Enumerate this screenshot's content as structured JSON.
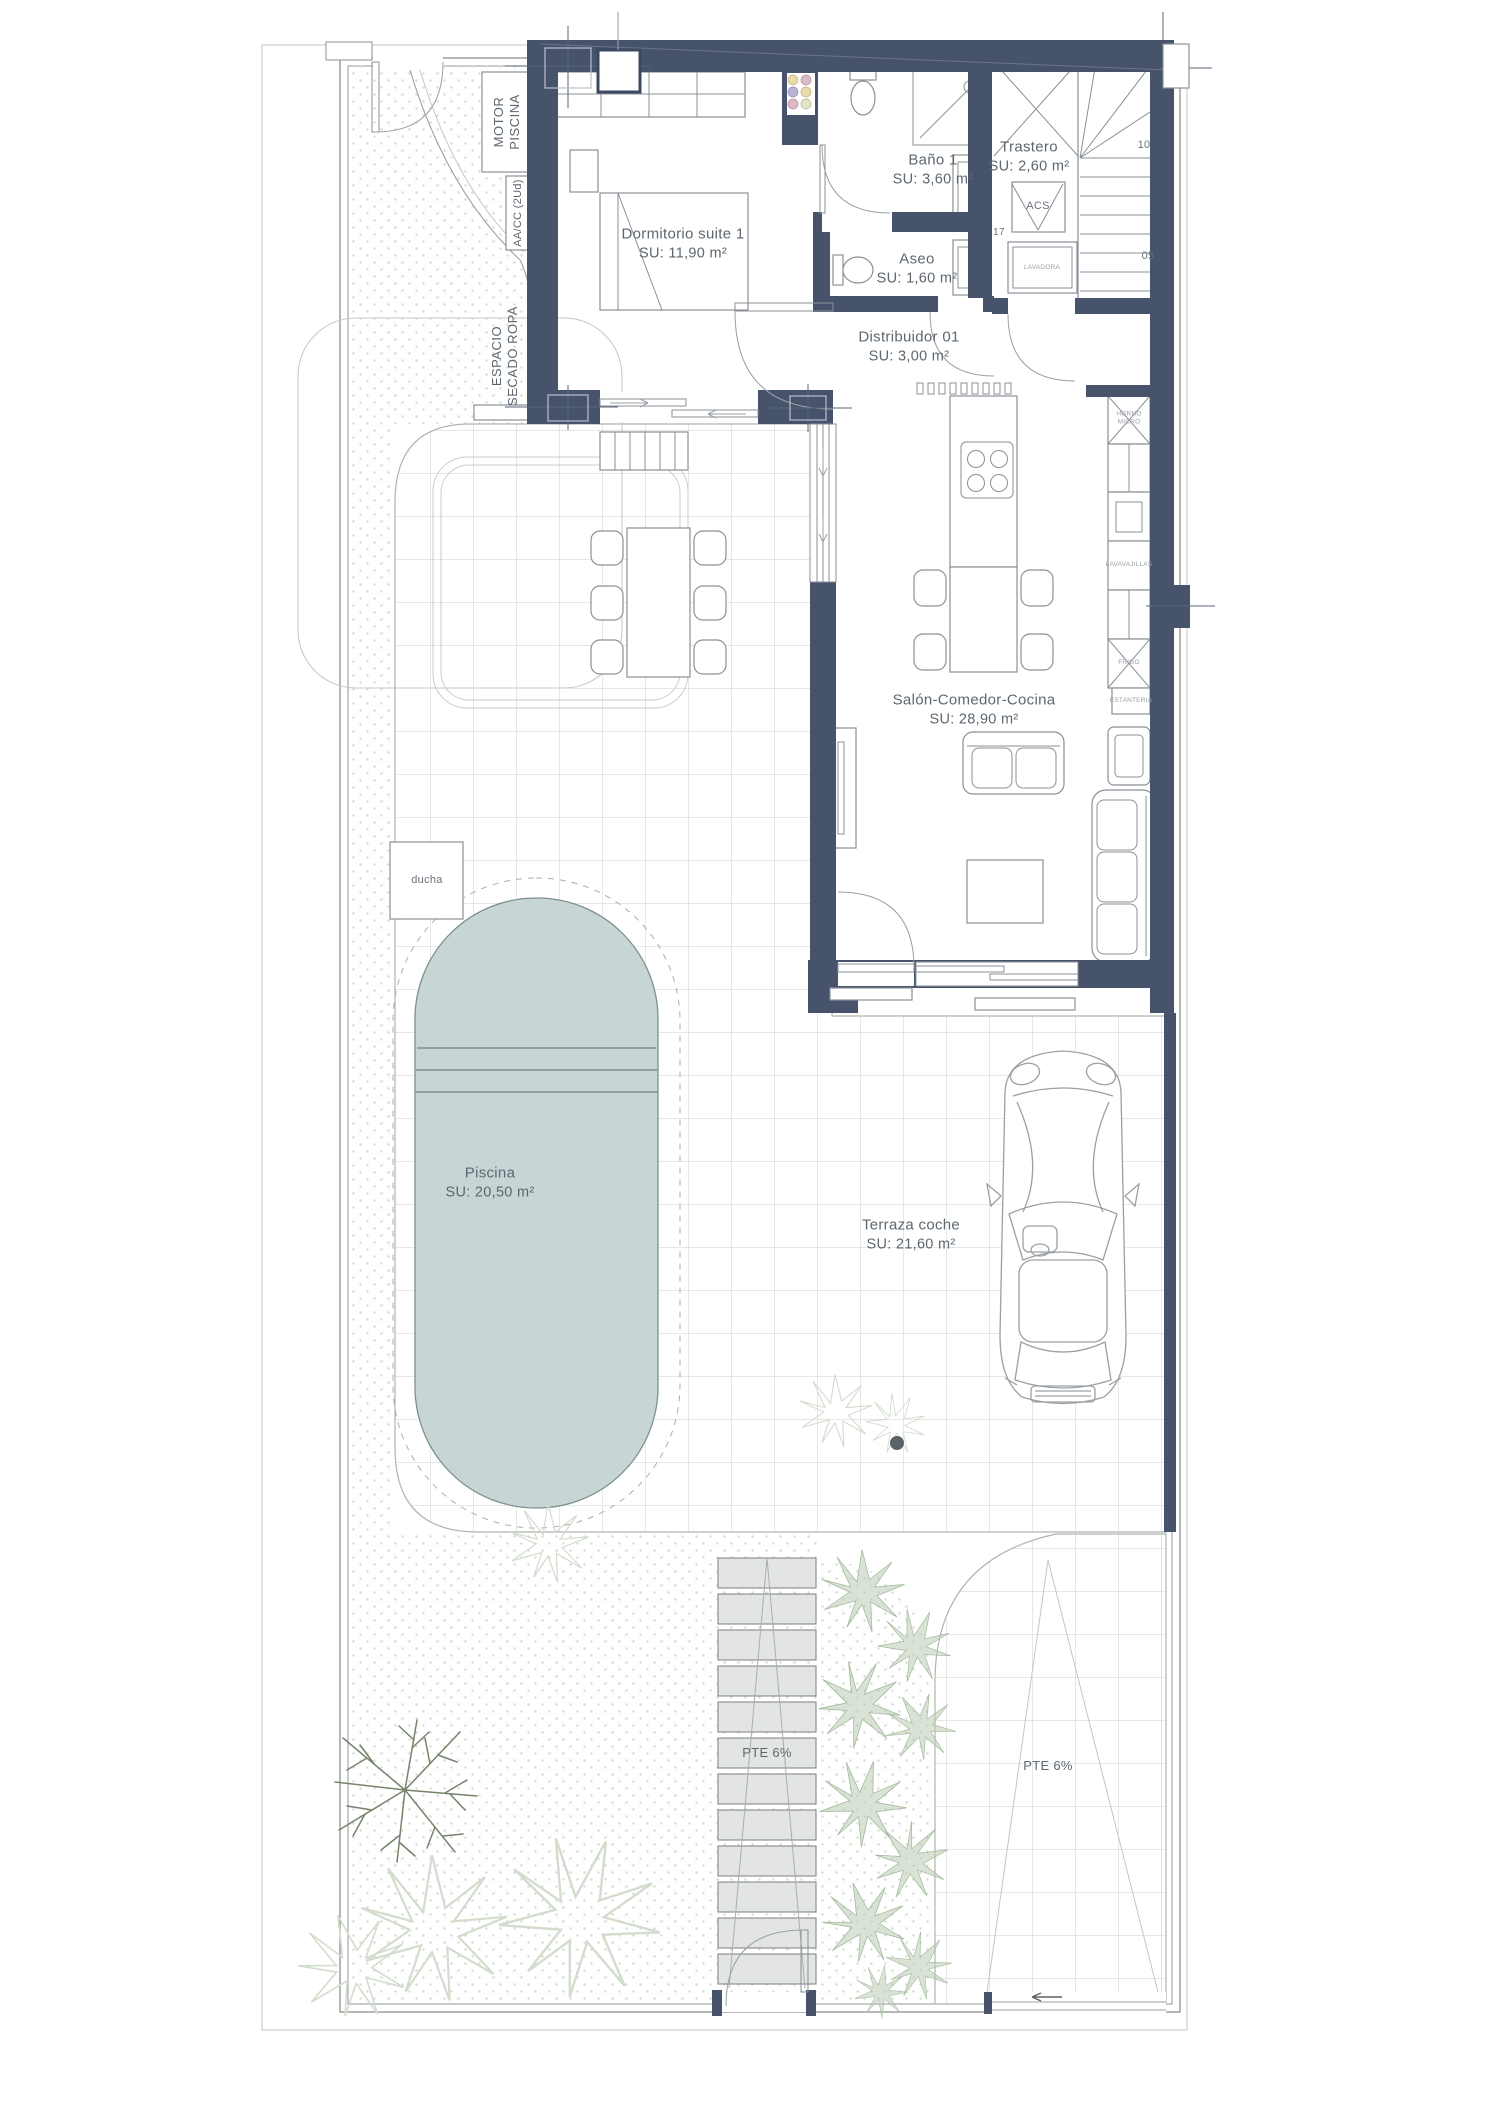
{
  "colors": {
    "wall": "#47536b",
    "pool_fill": "#c7d5d5",
    "pool_line": "#7d9191",
    "grid_line": "#cbd0cb",
    "ramp_fill": "#e3e5e4",
    "plant_green": "#b9ccb2",
    "text": "#5d6770"
  },
  "rooms": {
    "dormitorio": {
      "name": "Dormitorio suite 1",
      "area": "SU: 11,90 m²"
    },
    "bano1": {
      "name": "Baño 1",
      "area": "SU: 3,60 m²"
    },
    "trastero": {
      "name": "Trastero",
      "area": "SU: 2,60 m²"
    },
    "aseo": {
      "name": "Aseo",
      "area": "SU: 1,60 m²"
    },
    "distribuidor": {
      "name": "Distribuidor 01",
      "area": "SU: 3,00 m²"
    },
    "salon": {
      "name": "Salón-Comedor-Cocina",
      "area": "SU: 28,90 m²"
    },
    "piscina": {
      "name": "Piscina",
      "area": "SU: 20,50 m²"
    },
    "terraza": {
      "name": "Terraza coche",
      "area": "SU: 21,60 m²"
    }
  },
  "equipment": {
    "motor_line1": "MOTOR",
    "motor_line2": "PISCINA",
    "aacc": "AA/CC (2Ud)",
    "espacio_line1": "ESPACIO",
    "espacio_line2": "SECADO ROPA",
    "ducha": "ducha",
    "acs": "ACS",
    "lavadora": "LAVADORA",
    "horno_line1": "HORNO",
    "horno_line2": "MICRO",
    "lavavajillas": "LAVAVAJILLAS",
    "frigo": "FRIGO",
    "estanteria": "ESTANTERIA"
  },
  "site": {
    "pte_ramp": "PTE 6%",
    "pte_driveway": "PTE 6%"
  },
  "stairs": {
    "step10": "10",
    "step05": "05",
    "step17": "17"
  }
}
